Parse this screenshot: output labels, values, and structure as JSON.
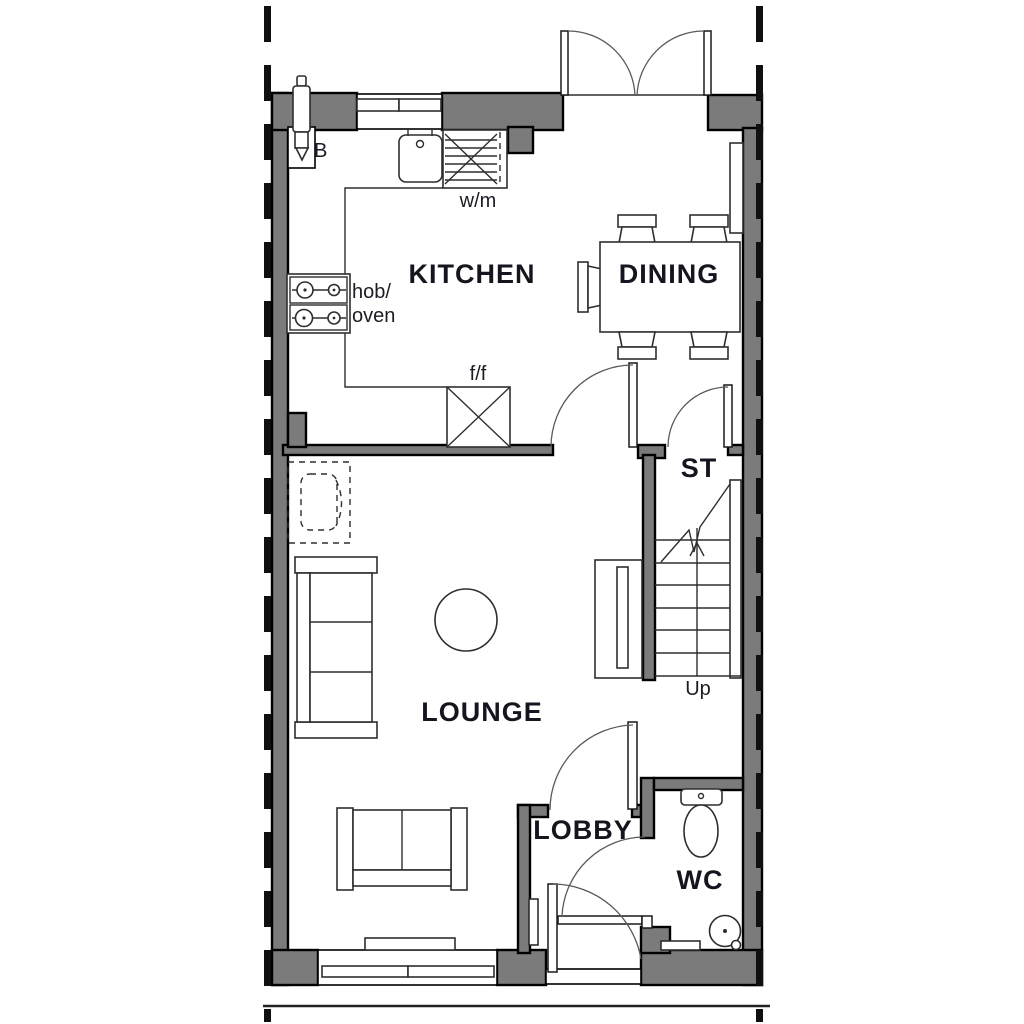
{
  "title": "Ground floor plan",
  "rooms": {
    "kitchen": "KITCHEN",
    "dining": "DINING",
    "store": "ST",
    "lounge": "LOUNGE",
    "lobby": "LOBBY",
    "wc": "WC"
  },
  "annotations": {
    "boiler": "B",
    "washing_machine": "w/m",
    "hob_line1": "hob/",
    "hob_line2": "oven",
    "fridge_freezer": "f/f",
    "stairs_up": "Up"
  },
  "colors": {
    "wall": "#7b7b7b",
    "outline": "#000000",
    "furniture_line": "#2e2e2e",
    "label": "#15151f",
    "background": "#ffffff"
  }
}
